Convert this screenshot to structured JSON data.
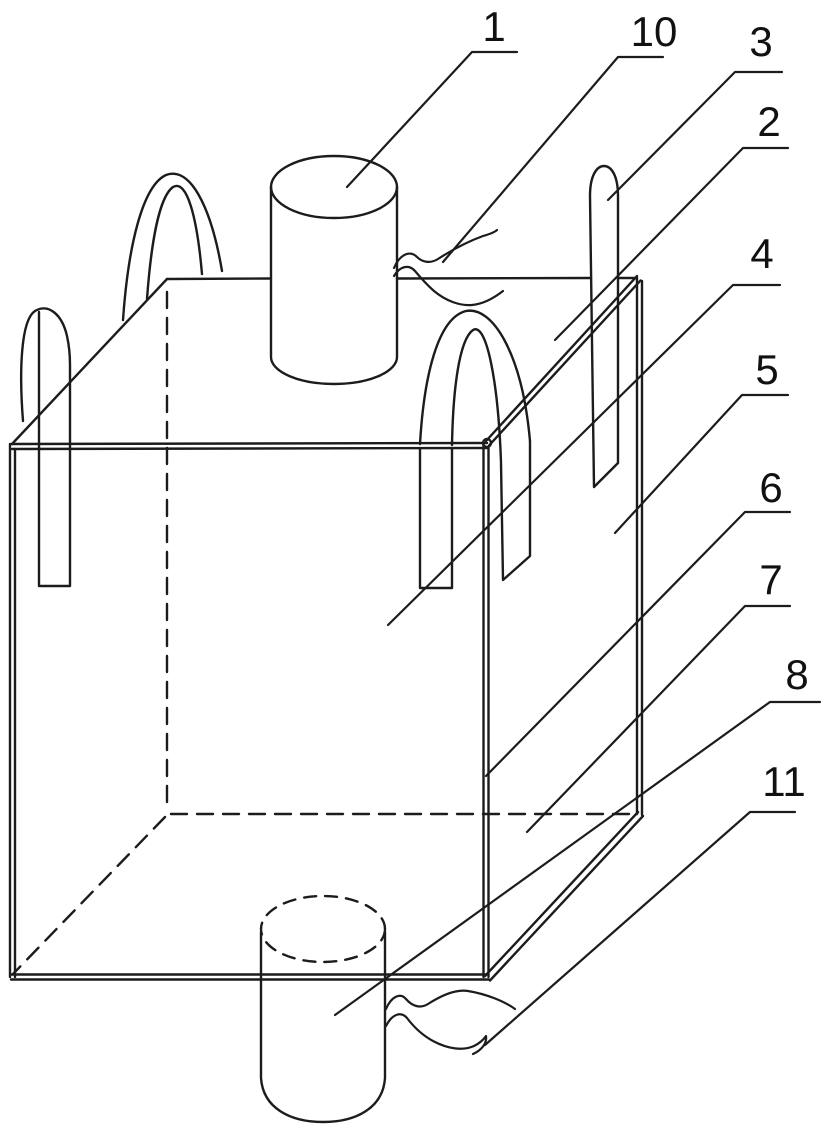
{
  "figure": {
    "kind": "patent-line-drawing",
    "background_color": "#ffffff",
    "line_color": "#1c1c1c",
    "label_color": "#111111"
  },
  "reference_labels": [
    {
      "number": "1",
      "text_x": 494,
      "text_y": 41,
      "leader": [
        [
          517,
          52
        ],
        [
          472,
          52
        ],
        [
          347,
          187
        ]
      ]
    },
    {
      "number": "10",
      "text_x": 654,
      "text_y": 46,
      "leader": [
        [
          663,
          57
        ],
        [
          618,
          57
        ],
        [
          443,
          262
        ]
      ]
    },
    {
      "number": "3",
      "text_x": 761,
      "text_y": 56,
      "leader": [
        [
          782,
          72
        ],
        [
          735,
          72
        ],
        [
          608,
          200
        ]
      ]
    },
    {
      "number": "2",
      "text_x": 769,
      "text_y": 136,
      "leader": [
        [
          788,
          148
        ],
        [
          743,
          148
        ],
        [
          555,
          340
        ]
      ]
    },
    {
      "number": "4",
      "text_x": 762,
      "text_y": 268,
      "leader": [
        [
          780,
          285
        ],
        [
          733,
          285
        ],
        [
          388,
          625
        ]
      ]
    },
    {
      "number": "5",
      "text_x": 767,
      "text_y": 384,
      "leader": [
        [
          788,
          395
        ],
        [
          742,
          395
        ],
        [
          615,
          533
        ]
      ]
    },
    {
      "number": "6",
      "text_x": 771,
      "text_y": 502,
      "leader": [
        [
          790,
          512
        ],
        [
          745,
          512
        ],
        [
          486,
          776
        ]
      ]
    },
    {
      "number": "7",
      "text_x": 771,
      "text_y": 594,
      "leader": [
        [
          790,
          606
        ],
        [
          745,
          606
        ],
        [
          527,
          832
        ]
      ]
    },
    {
      "number": "8",
      "text_x": 797,
      "text_y": 689,
      "leader": [
        [
          820,
          702
        ],
        [
          770,
          702
        ],
        [
          335,
          1015
        ]
      ]
    },
    {
      "number": "11",
      "text_x": 784,
      "text_y": 796,
      "leader": [
        [
          795,
          812
        ],
        [
          750,
          812
        ],
        [
          485,
          1045
        ]
      ]
    }
  ]
}
